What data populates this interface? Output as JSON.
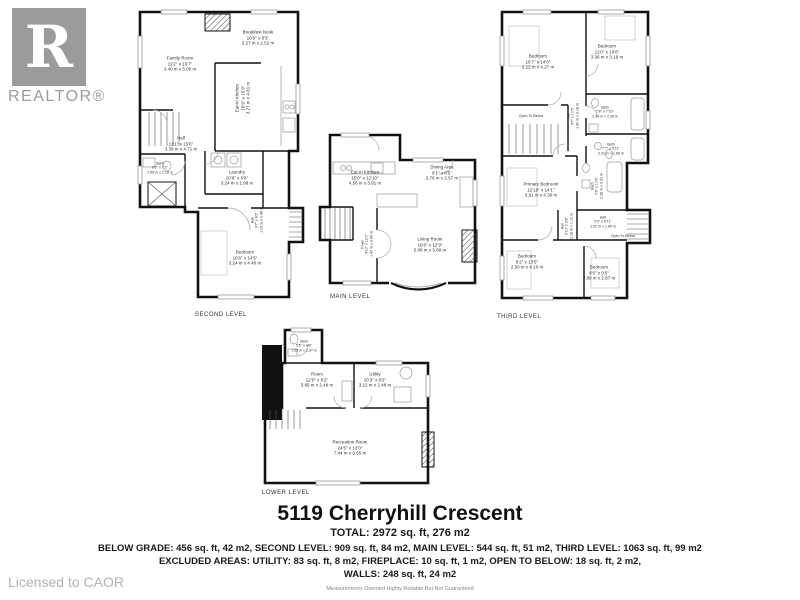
{
  "branding": {
    "logo_letter": "R",
    "logo_text": "REALTOR®",
    "licensed_text": "Licensed to CAOR"
  },
  "footer": {
    "title": "5119 Cherryhill Crescent",
    "total": "TOTAL: 2972 sq. ft, 276 m2",
    "areas_line": "BELOW GRADE: 456 sq. ft, 42 m2, SECOND LEVEL: 909 sq. ft, 84 m2, MAIN LEVEL: 544 sq. ft, 51 m2, THIRD LEVEL: 1063 sq. ft, 99 m2",
    "excluded_line": "EXCLUDED AREAS: UTILITY: 83 sq. ft, 8 m2, FIREPLACE: 10 sq. ft, 1 m2, OPEN TO BELOW: 18 sq. ft, 2 m2,",
    "walls_line": "WALLS: 248 sq. ft, 24 m2",
    "disclaimer": "Measurements Deemed Highly Reliable But Not Guaranteed"
  },
  "floors": {
    "second": {
      "label": "SECOND LEVEL",
      "rooms": {
        "breakfast_nook": {
          "name": "Breakfast Nook",
          "ft": "10'9\" x 8'3\"",
          "m": "3.27 m x 2.52 m"
        },
        "family_room": {
          "name": "Family Room",
          "ft": "11'2\" x 16'7\"",
          "m": "3.40 m x 5.06 m"
        },
        "eat_in_kitchen": {
          "name": "Eat-in Kitchen",
          "ft": "10'9\" x 15'9\"",
          "m": "3.27 m x 4.81 m"
        },
        "hall": {
          "name": "Hall",
          "ft": "11'1\" x 15'6\"",
          "m": "3.39 m x 4.71 m"
        },
        "bath": {
          "name": "Bath",
          "ft": "6'5\" x 7'2\"",
          "m": "1.95 m x 2.18 m"
        },
        "laundry": {
          "name": "Laundry",
          "ft": "10'8\" x 6'6\"",
          "m": "3.24 m x 1.98 m"
        },
        "hall_small": {
          "name": "Hall",
          "ft": "3'7\" x 8'2\"",
          "m": "1.09 m x 2.48 m"
        },
        "bedroom": {
          "name": "Bedroom",
          "ft": "10'8\" x 14'5\"",
          "m": "3.24 m x 4.40 m"
        }
      }
    },
    "main": {
      "label": "MAIN LEVEL",
      "rooms": {
        "eat_in_kitchen": {
          "name": "Eat-in Kitchen",
          "ft": "15'0\" x 12'10\"",
          "m": "4.56 m x 3.91 m"
        },
        "dining_area": {
          "name": "Dining Area",
          "ft": "9'1\" x 8'5\"",
          "m": "2.76 m x 2.57 m"
        },
        "living_room": {
          "name": "Living Room",
          "ft": "16'8\" x 12'9\"",
          "m": "5.08 m x 3.89 m"
        },
        "foyer": {
          "name": "Foyer",
          "ft": "4'10\" x 12'0\"",
          "m": "1.47 m x 3.66 m"
        }
      }
    },
    "third": {
      "label": "THIRD LEVEL",
      "rooms": {
        "bedroom_nw": {
          "name": "Bedroom",
          "ft": "10'7\" x 14'0\"",
          "m": "3.22 m x 4.27 m"
        },
        "bedroom_ne": {
          "name": "Bedroom",
          "ft": "11'0\" x 10'6\"",
          "m": "3.36 m x 3.19 m"
        },
        "hall_upper": {
          "name": "Hall",
          "ft": "4'7\" x 10'5\"",
          "m": "1.40 m x 3.18 m"
        },
        "bath_ne": {
          "name": "Bath",
          "ft": "7'8\" x 7'10\"",
          "m": "2.34 m x 2.39 m"
        },
        "open_below_upper": {
          "name": "Open To Below"
        },
        "primary_bedroom": {
          "name": "Primary Bedroom",
          "ft": "12'10\" x 14'1\"",
          "m": "3.91 m x 4.30 m"
        },
        "bath_e": {
          "name": "Bath",
          "ft": "7'6\" x 10'6\"",
          "m": "2.28 m x 3.20 m"
        },
        "bath_se": {
          "name": "Bath",
          "ft": "7'7\" x 5'11\"",
          "m": "2.31 m x 1.80 m"
        },
        "hall_center": {
          "name": "Hall",
          "ft": "5'0\" x 5'11\"",
          "m": "1.52 m x 1.80 m"
        },
        "open_below_small": {
          "name": "Open To Below"
        },
        "hall_small": {
          "name": "Hall",
          "ft": "6'10\" x 3'8\"",
          "m": "2.08 m x 1.12 m"
        },
        "bedroom_sw": {
          "name": "Bedroom",
          "ft": "8'2\" x 13'5\"",
          "m": "2.50 m x 4.10 m"
        },
        "bedroom_se": {
          "name": "Bedroom",
          "ft": "9'6\" x 9'5\"",
          "m": "2.88 m x 2.87 m"
        }
      }
    },
    "lower": {
      "label": "LOWER LEVEL",
      "rooms": {
        "bath": {
          "name": "Bath",
          "ft": "5'5\" x 4'6\"",
          "m": "1.65 m x 1.37 m"
        },
        "room": {
          "name": "Room",
          "ft": "12'0\" x 8'2\"",
          "m": "3.66 m x 2.48 m"
        },
        "utility": {
          "name": "Utility",
          "ft": "10'3\" x 8'2\"",
          "m": "3.12 m x 2.48 m"
        },
        "recreation": {
          "name": "Recreation Room",
          "ft": "24'5\" x 12'0\"",
          "m": "7.44 m x 3.65 m"
        }
      }
    }
  }
}
